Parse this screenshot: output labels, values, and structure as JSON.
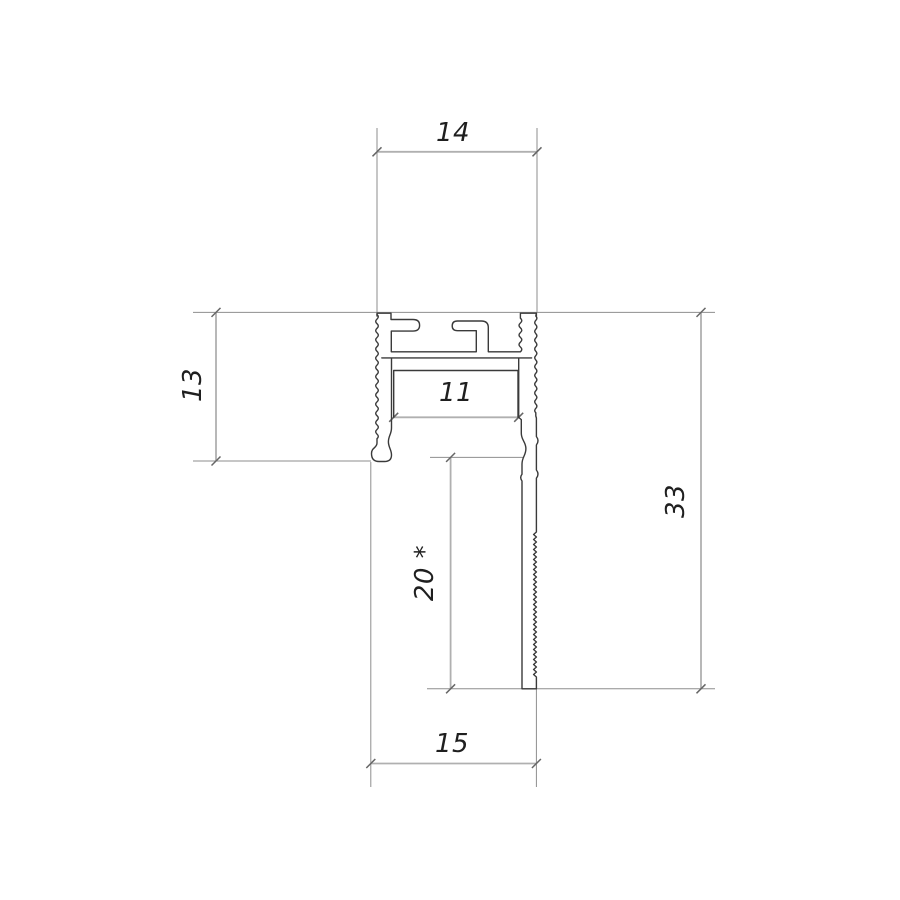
{
  "drawing": {
    "kind": "profile-cross-section-technical-drawing",
    "background": "#ffffff",
    "outline_color": "#3a3a3a",
    "ext_line_color": "#8e8e8e",
    "dim_line_color": "#b0b0b0",
    "tick_color": "#666666",
    "text_color": "#1f1f1f",
    "dim_labels": {
      "top_width": "14",
      "left_height": "13",
      "inner_width": "11",
      "right_height": "33",
      "lower_depth": "20 *",
      "bottom_width": "15"
    }
  }
}
